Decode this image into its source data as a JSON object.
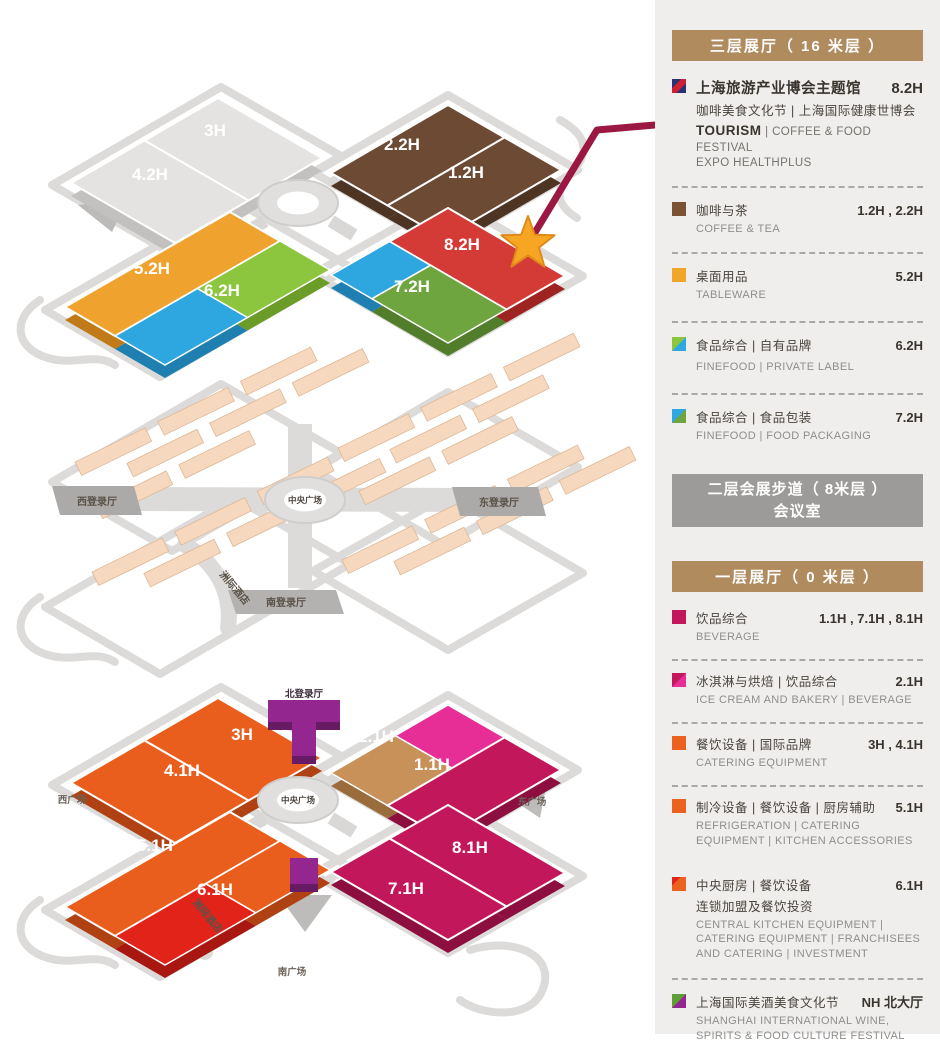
{
  "sidebar": {
    "floor3_header": "三层展厅（ 16 米层 ）",
    "feature": {
      "cn": "上海旅游产业博会主题馆",
      "halls": "8.2H",
      "cn2": "咖啡美食文化节 | 上海国际健康世博会",
      "en1": "TOURISM",
      "en1b": "| COFFEE & FOOD FESTIVAL",
      "en2": "EXPO HEALTHPLUS",
      "icon": {
        "type": "band",
        "c1": "#2A3176",
        "c2": "#CE2030"
      }
    },
    "items3f": [
      {
        "cn": "咖啡与茶",
        "en": "COFFEE & TEA",
        "halls": "1.2H , 2.2H",
        "icon": {
          "type": "solid",
          "c1": "#7B5233"
        }
      },
      {
        "cn": "桌面用品",
        "en": "TABLEWARE",
        "halls": "5.2H",
        "icon": {
          "type": "solid",
          "c1": "#F0A62B"
        }
      },
      {
        "cn": "食品综合 | 自有品牌",
        "en": "FINEFOOD | PRIVATE LABEL",
        "halls": "6.2H",
        "icon": {
          "type": "diag",
          "c1": "#8CC63E",
          "c2": "#2FA8E1"
        }
      },
      {
        "cn": "食品综合 | 食品包装",
        "en": "FINEFOOD | FOOD PACKAGING",
        "halls": "7.2H",
        "icon": {
          "type": "diag",
          "c1": "#2FA8E1",
          "c2": "#6FA53F"
        }
      }
    ],
    "floor2_header1": "二层会展步道（ 8米层 ）",
    "floor2_header2": "会议室",
    "floor1_header": "一层展厅（ 0 米层 ）",
    "items1f": [
      {
        "cn": "饮品综合",
        "en": "BEVERAGE",
        "halls": "1.1H , 7.1H , 8.1H",
        "icon": {
          "type": "solid",
          "c1": "#C2175B"
        }
      },
      {
        "cn": "冰淇淋与烘焙 | 饮品综合",
        "en": "ICE CREAM AND BAKERY  |  BEVERAGE",
        "halls": "2.1H",
        "icon": {
          "type": "diag",
          "c1": "#C2175B",
          "c2": "#E62E96"
        }
      },
      {
        "cn": "餐饮设备 | 国际品牌",
        "en": "CATERING EQUIPMENT",
        "halls": "3H , 4.1H",
        "icon": {
          "type": "solid",
          "c1": "#EB6120"
        }
      },
      {
        "cn": "制冷设备 | 餐饮设备 | 厨房辅助",
        "en": "REFRIGERATION | CATERING EQUIPMENT | KITCHEN ACCESSORIES",
        "halls": "5.1H",
        "icon": {
          "type": "solid",
          "c1": "#EB6120"
        }
      },
      {
        "cn": "中央厨房 | 餐饮设备",
        "cn2": "连锁加盟及餐饮投资",
        "en": "CENTRAL KITCHEN EQUIPMENT  |  CATERING EQUIPMENT  |  FRANCHISEES AND CATERING | INVESTMENT",
        "halls": "6.1H",
        "icon": {
          "type": "corner",
          "c1": "#EB6120",
          "c2": "#E2231A"
        }
      },
      {
        "cn": "上海国际美酒美食文化节",
        "en": "SHANGHAI INTERNATIONAL WINE, SPIRITS & FOOD CULTURE FESTIVAL",
        "halls": "NH 北大厅",
        "icon": {
          "type": "diag",
          "c1": "#5F9E36",
          "c2": "#93278F"
        }
      }
    ]
  },
  "maps": {
    "floor3": {
      "halls": {
        "h3": "3H",
        "h42": "4.2H",
        "h22": "2.2H",
        "h12": "1.2H",
        "h52": "5.2H",
        "h62": "6.2H",
        "h72": "7.2H",
        "h82": "8.2H"
      }
    },
    "floor2": {
      "west": "西登录厅",
      "east": "东登录厅",
      "south": "南登录厅",
      "center": "中央广场",
      "hotel": "洲际酒店"
    },
    "floor1": {
      "halls": {
        "h3": "3H",
        "h41": "4.1H",
        "h21": "2.1H",
        "h11": "1.1H",
        "h51": "5.1H",
        "h61": "6.1H",
        "h71": "7.1H",
        "h81": "8.1H"
      },
      "north": "北登录厅",
      "west": "西广场",
      "east": "东广场",
      "south": "南广场",
      "center": "中央广场",
      "hotel": "洲际酒店"
    }
  }
}
